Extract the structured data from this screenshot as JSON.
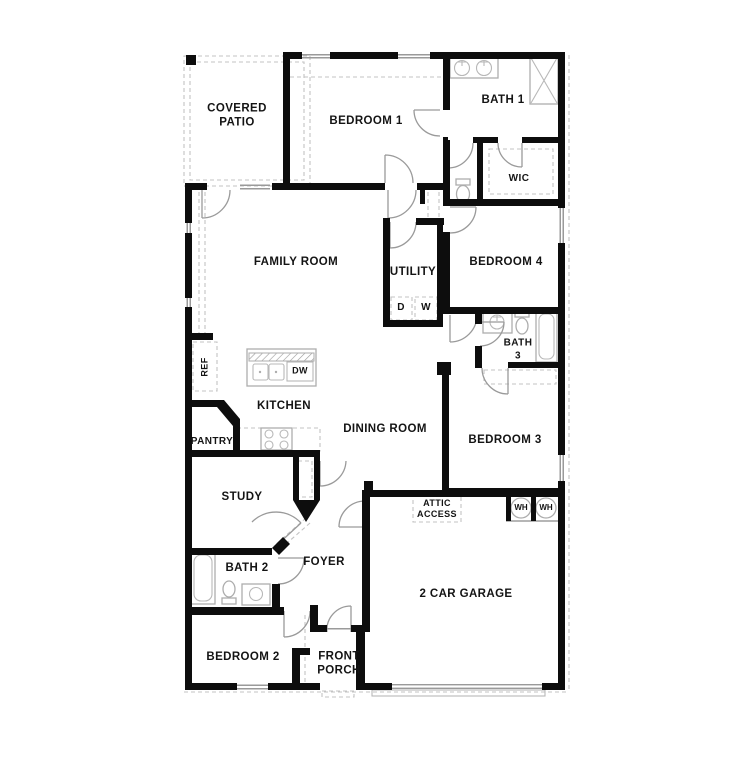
{
  "meta": {
    "type": "residential floor plan"
  },
  "colors": {
    "wall": "#0d0d0d",
    "door_arc": "#9a9a9a",
    "dashed_line": "#c3c3c3",
    "fixture_outline": "#adadad",
    "text": "#141414",
    "background": "#ffffff"
  },
  "rooms": {
    "covered_patio": [
      "COVERED",
      "PATIO"
    ],
    "bedroom1": "BEDROOM 1",
    "bath1": "BATH 1",
    "wic": "WIC",
    "bedroom4": "BEDROOM 4",
    "utility": "UTILITY",
    "family_room": "FAMILY ROOM",
    "kitchen": "KITCHEN",
    "pantry": "PANTRY",
    "dining_room": "DINING ROOM",
    "bath3": [
      "BATH",
      "3"
    ],
    "bedroom3": "BEDROOM 3",
    "study": "STUDY",
    "bath2": "BATH 2",
    "foyer": "FOYER",
    "bedroom2": "BEDROOM 2",
    "front_porch": [
      "FRONT",
      "PORCH"
    ],
    "garage": "2 CAR GARAGE",
    "attic_access": [
      "ATTIC",
      "ACCESS"
    ]
  },
  "appliances": {
    "dryer": "D",
    "washer": "W",
    "dishwasher": "DW",
    "refrigerator": "REF",
    "water_heater_left": "WH",
    "water_heater_right": "WH"
  }
}
